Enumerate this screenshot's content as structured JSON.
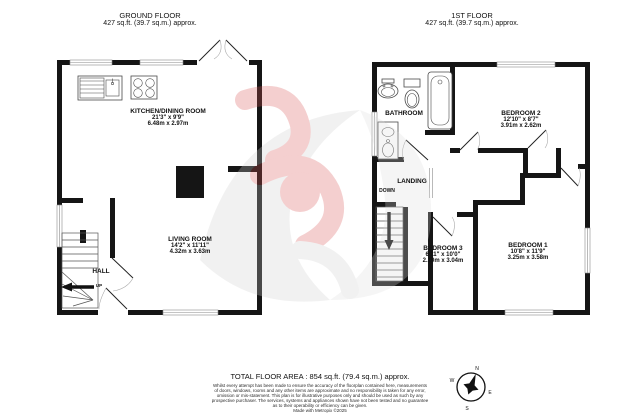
{
  "ground_floor": {
    "title": "GROUND FLOOR",
    "area": "427 sq.ft. (39.7 sq.m.) approx.",
    "rooms": {
      "kitchen": {
        "name": "KITCHEN/DINING ROOM",
        "imperial": "21'3\" x 9'9\"",
        "metric": "6.48m x 2.97m"
      },
      "living": {
        "name": "LIVING ROOM",
        "imperial": "14'2\" x 11'11\"",
        "metric": "4.32m x 3.63m"
      },
      "hall": {
        "name": "HALL"
      }
    },
    "stair_label": "UP"
  },
  "first_floor": {
    "title": "1ST FLOOR",
    "area": "427 sq.ft. (39.7 sq.m.) approx.",
    "rooms": {
      "bathroom": {
        "name": "BATHROOM"
      },
      "bedroom2": {
        "name": "BEDROOM 2",
        "imperial": "12'10\" x 8'7\"",
        "metric": "3.91m x 2.62m"
      },
      "landing": {
        "name": "LANDING"
      },
      "bedroom3": {
        "name": "BEDROOM 3",
        "imperial": "6'11\" x 10'0\"",
        "metric": "2.10m x 3.04m"
      },
      "bedroom1": {
        "name": "BEDROOM 1",
        "imperial": "10'8\" x 11'9\"",
        "metric": "3.25m x 3.58m"
      }
    },
    "stair_label": "DOWN"
  },
  "footer": {
    "total_area": "TOTAL FLOOR AREA : 854 sq.ft. (79.4 sq.m.) approx.",
    "disclaimer_lines": [
      "Whilst every attempt has been made to ensure the accuracy of the floorplan contained here, measurements",
      "of doors, windows, rooms and any other items are approximate and no responsibility is taken for any error,",
      "omission or mis-statement. This plan is for illustrative purposes only and should be used as such by any",
      "prospective purchaser. The services, systems and appliances shown have not been tested and no guarantee",
      "as to their operability or efficiency can be given."
    ],
    "credit": "Made with Metropix ©2025"
  },
  "compass": {
    "n": "N",
    "e": "E",
    "s": "S",
    "w": "W"
  },
  "colors": {
    "wall": "#151515",
    "watermark_red": "#d95555",
    "watermark_gray": "#d6d6d6"
  }
}
